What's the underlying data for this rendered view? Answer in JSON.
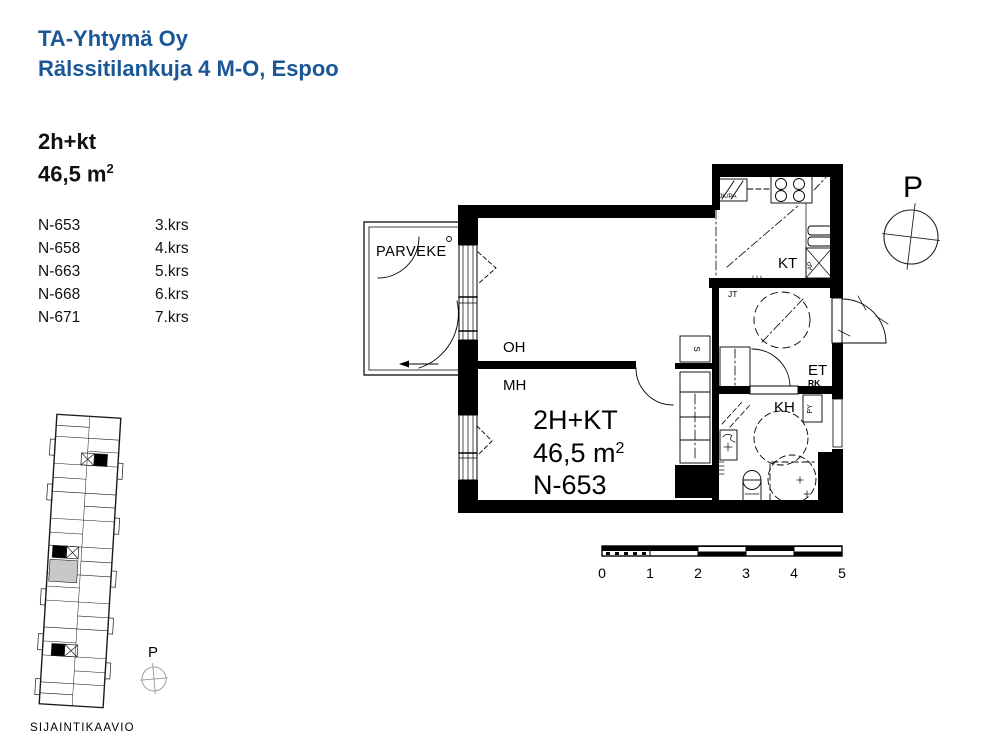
{
  "header": {
    "company": "TA-Yhtymä Oy",
    "address": "Rälssitilankuja 4 M-O, Espoo",
    "accent_color": "#1b5796"
  },
  "apartment": {
    "type": "2h+kt",
    "area_value": "46,5 m",
    "area_exp": "2"
  },
  "units": [
    {
      "id": "N-653",
      "floor": "3.krs"
    },
    {
      "id": "N-658",
      "floor": "4.krs"
    },
    {
      "id": "N-663",
      "floor": "5.krs"
    },
    {
      "id": "N-668",
      "floor": "6.krs"
    },
    {
      "id": "N-671",
      "floor": "7.krs"
    }
  ],
  "floorplan": {
    "balcony": "PARVEKE",
    "living_room": "OH",
    "bedroom": "MH",
    "unit_type": "2H+KT",
    "unit_area": "46,5 m",
    "unit_area_exp": "2",
    "unit_id": "N-653",
    "kitchen": "KT",
    "jt": "JT",
    "entry": "ET",
    "rk": "RK",
    "bathroom": "KH",
    "py": "PY",
    "closet_s": "S",
    "fridge": "JK/PA",
    "dishwasher": "AP"
  },
  "compass": {
    "north": "P"
  },
  "siteplan": {
    "title": "SIJAINTIKAAVIO",
    "north": "P"
  },
  "scalebar": {
    "ticks": [
      "0",
      "1",
      "2",
      "3",
      "4",
      "5"
    ]
  }
}
